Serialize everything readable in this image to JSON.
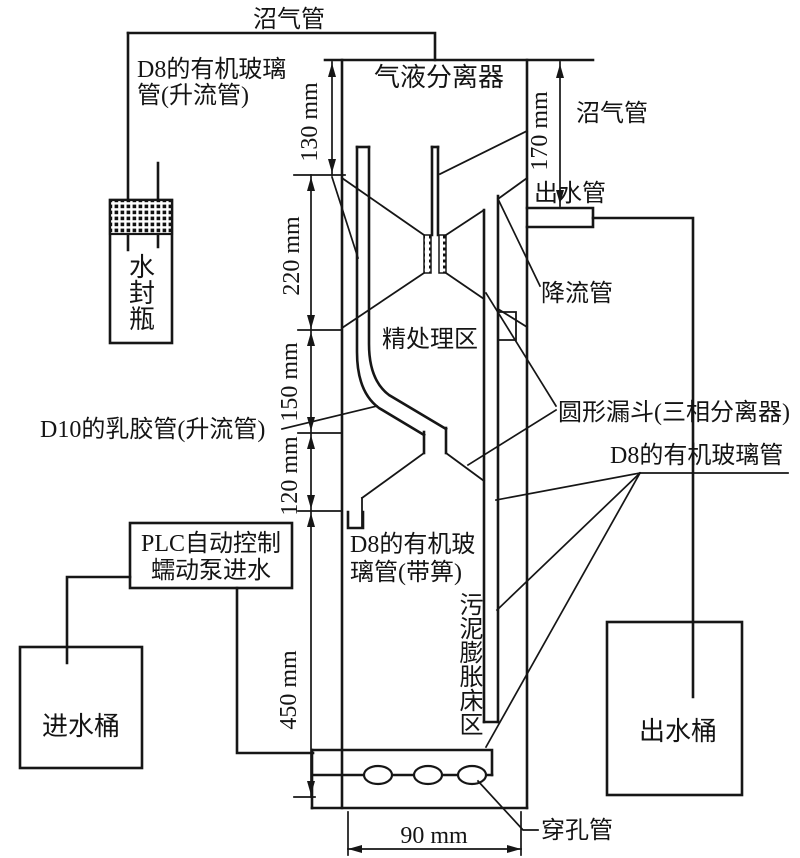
{
  "diagram": {
    "title_note": "UASB-type reactor schematic",
    "labels": {
      "biogas_top": "沼气管",
      "d8_glass_riser_l1": "D8的有机玻璃",
      "d8_glass_riser_l2": "管(升流管)",
      "water_seal_bottle": "水封瓶",
      "gas_liquid_separator": "气液分离器",
      "biogas_right": "沼气管",
      "outlet_pipe": "出水管",
      "downflow_pipe": "降流管",
      "fine_treatment_zone": "精处理区",
      "d10_latex_riser": "D10的乳胶管(升流管)",
      "circular_funnel": "圆形漏斗(三相分离器)",
      "d8_glass_pipe": "D8的有机玻璃管",
      "d8_grate_l1": "D8的有机玻",
      "d8_grate_l2": "璃管(带箅)",
      "plc_l1": "PLC自动控制",
      "plc_l2": "蠕动泵进水",
      "inlet_bucket": "进水桶",
      "outlet_bucket": "出水桶",
      "sludge_expansion_zone": "污泥膨胀床区",
      "perforated_pipe": "穿孔管"
    },
    "dimensions": {
      "d130": "130 mm",
      "d220": "220 mm",
      "d150": "150 mm",
      "d120": "120 mm",
      "d450": "450 mm",
      "d170": "170 mm",
      "d90": "90 mm"
    },
    "colors": {
      "line": "#161616",
      "background": "#ffffff"
    }
  }
}
